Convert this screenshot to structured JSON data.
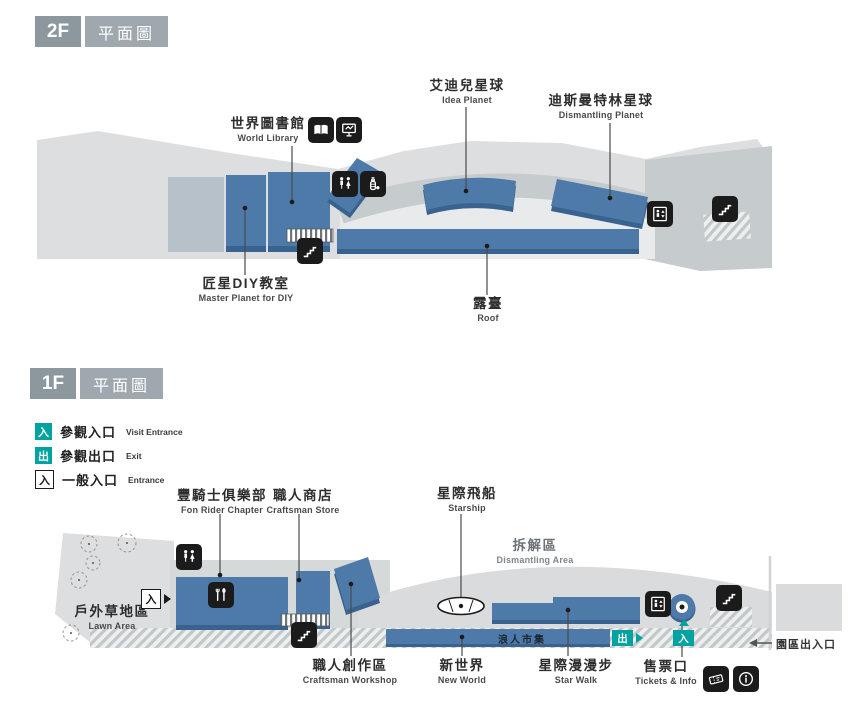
{
  "colors": {
    "teal": "#00a3a0",
    "building_blue": "#4d7aa8",
    "building_blue_dark": "#3a628e",
    "site_gray": "#dcdee0",
    "mid_gray": "#c6cbce",
    "blue_gray_annex": "#b6c1ca",
    "icon_black": "#1b1b1b",
    "badge_dark": "#8d979e",
    "badge_light": "#9ea8ae"
  },
  "f2": {
    "floor": "2F",
    "plan_label": "平面圖",
    "labels": {
      "world_library": {
        "zh": "世界圖書館",
        "en": "World Library"
      },
      "idea_planet": {
        "zh": "艾迪兒星球",
        "en": "Idea Planet"
      },
      "dismantling_planet": {
        "zh": "迪斯曼特林星球",
        "en": "Dismantling Planet"
      },
      "master_planet_diy": {
        "zh": "匠星DIY教室",
        "en": "Master Planet for DIY"
      },
      "roof": {
        "zh": "露臺",
        "en": "Roof"
      }
    },
    "icons": [
      "book",
      "presentation",
      "restroom",
      "nursing-room",
      "elevator",
      "stairs"
    ]
  },
  "f1": {
    "floor": "1F",
    "plan_label": "平面圖",
    "legend": [
      {
        "symbol": "入",
        "zh": "參觀入口",
        "en": "Visit Entrance",
        "style": "teal"
      },
      {
        "symbol": "出",
        "zh": "參觀出口",
        "en": "Exit",
        "style": "teal"
      },
      {
        "symbol": "入",
        "zh": "一般入口",
        "en": "Entrance",
        "style": "outline"
      }
    ],
    "labels": {
      "fon_rider_chapter": {
        "zh": "豐騎士俱樂部",
        "en": "Fon Rider Chapter"
      },
      "craftsman_store": {
        "zh": "職人商店",
        "en": "Craftsman Store"
      },
      "starship": {
        "zh": "星際飛船",
        "en": "Starship"
      },
      "dismantling_area": {
        "zh": "拆解區",
        "en": "Dismantling Area"
      },
      "lawn_area": {
        "zh": "戶外草地區",
        "en": "Lawn Area"
      },
      "craftsman_workshop": {
        "zh": "職人創作區",
        "en": "Craftsman Workshop"
      },
      "new_world": {
        "zh": "新世界",
        "en": "New World"
      },
      "star_walk": {
        "zh": "星際漫漫步",
        "en": "Star Walk"
      },
      "tickets_info": {
        "zh": "售票口",
        "en": "Tickets & Info"
      },
      "market": {
        "zh": "浪人市集"
      },
      "park_gate": {
        "zh": "園區出入口"
      }
    },
    "markers": {
      "general_entrance": "入",
      "visit_exit": "出",
      "visit_entrance": "入"
    },
    "icons": [
      "restroom",
      "restaurant",
      "stairs",
      "elevator",
      "ticket",
      "info"
    ]
  }
}
